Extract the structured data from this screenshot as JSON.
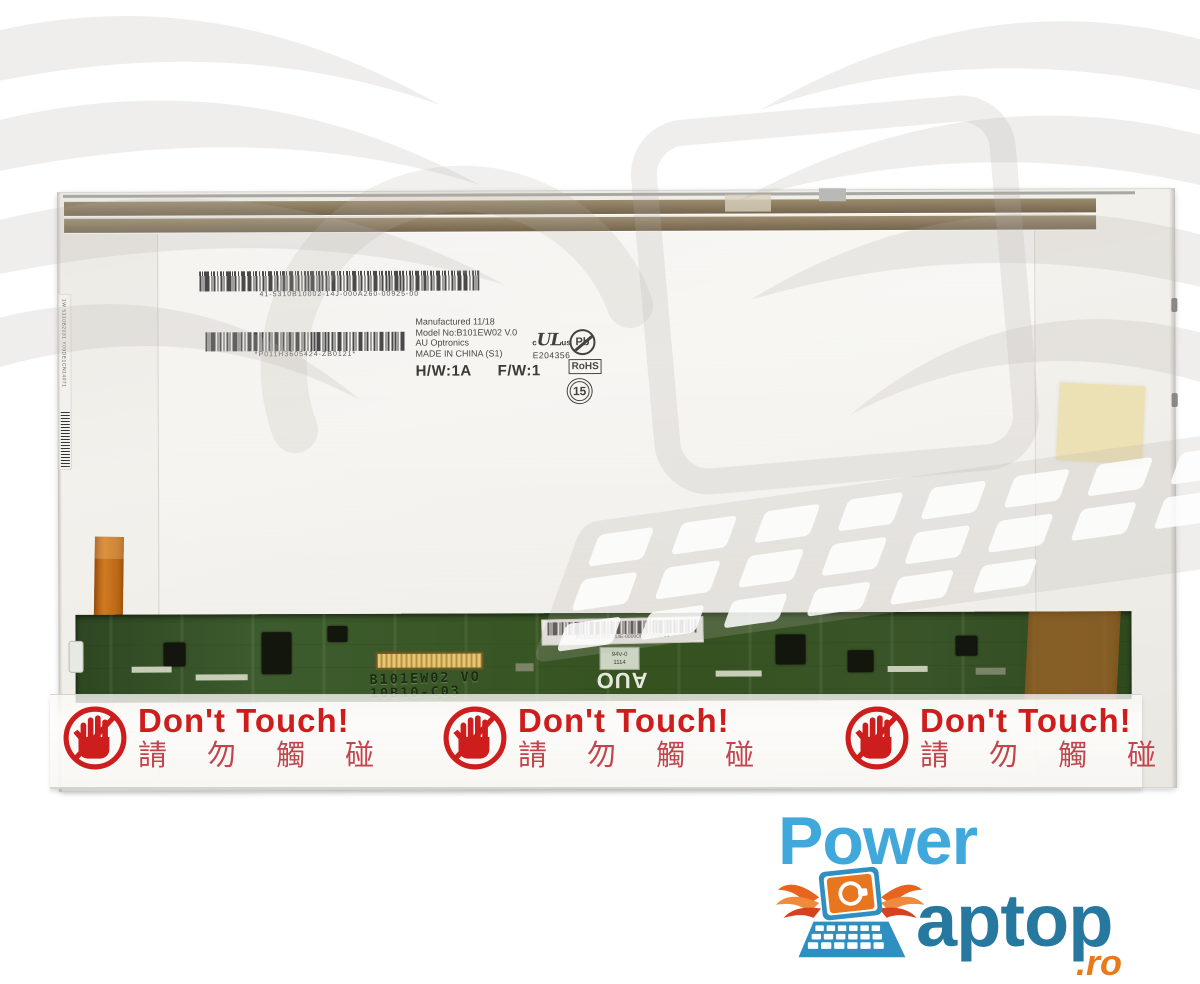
{
  "panel": {
    "top_barcode": {
      "text": "41-5310B10002-14J-000A260-00925-00"
    },
    "second_barcode": {
      "text": "*P011H3605424-ZB0121*"
    },
    "side_label": {
      "text": "1W 5310B2031 Y09DE1CN14071"
    },
    "spec_label": {
      "manufactured": "Manufactured 11/18",
      "model_line": "Model No:B101EW02  V.0",
      "maker": "AU Optronics",
      "origin": "MADE IN CHINA (S1)",
      "hw": "H/W:1A",
      "fw": "F/W:1"
    },
    "certifications": {
      "ul_prefix": "c",
      "ul": "UL",
      "ul_suffix": "us",
      "ul_file": "E204356",
      "pb": "Pb",
      "rohs": "RoHS",
      "recycle": "15"
    }
  },
  "pcb": {
    "silkscreen_model": "B101EW02 VO",
    "silkscreen_rev": "10B10-C03",
    "label_barcode": "P8-5510B10C03-14E-0000OD0-02195-04",
    "ratings_label_line1": "94V-0",
    "ratings_label_line2": "1114",
    "auo_logo": "AUO"
  },
  "warning_tape": {
    "labels": [
      {
        "title": "Don't Touch!",
        "subtitle": "請 勿 觸 碰"
      },
      {
        "title": "Don't Touch!",
        "subtitle": "請 勿 觸 碰"
      },
      {
        "title": "Don't Touch!",
        "subtitle": "請 勿 觸 碰"
      }
    ]
  },
  "brand_logo": {
    "word_power": "Power",
    "word_aptop": "aptop",
    "tld": ".ro",
    "colors": {
      "power_blue": "#41a8dc",
      "aptop_blue": "#26789f",
      "orange": "#e87a1a",
      "wing_orange": "#e8641e",
      "warning_red": "#ce1d1d",
      "warning_red_soft": "#c2454e",
      "watermark_gray": "#b7b3ac"
    }
  }
}
